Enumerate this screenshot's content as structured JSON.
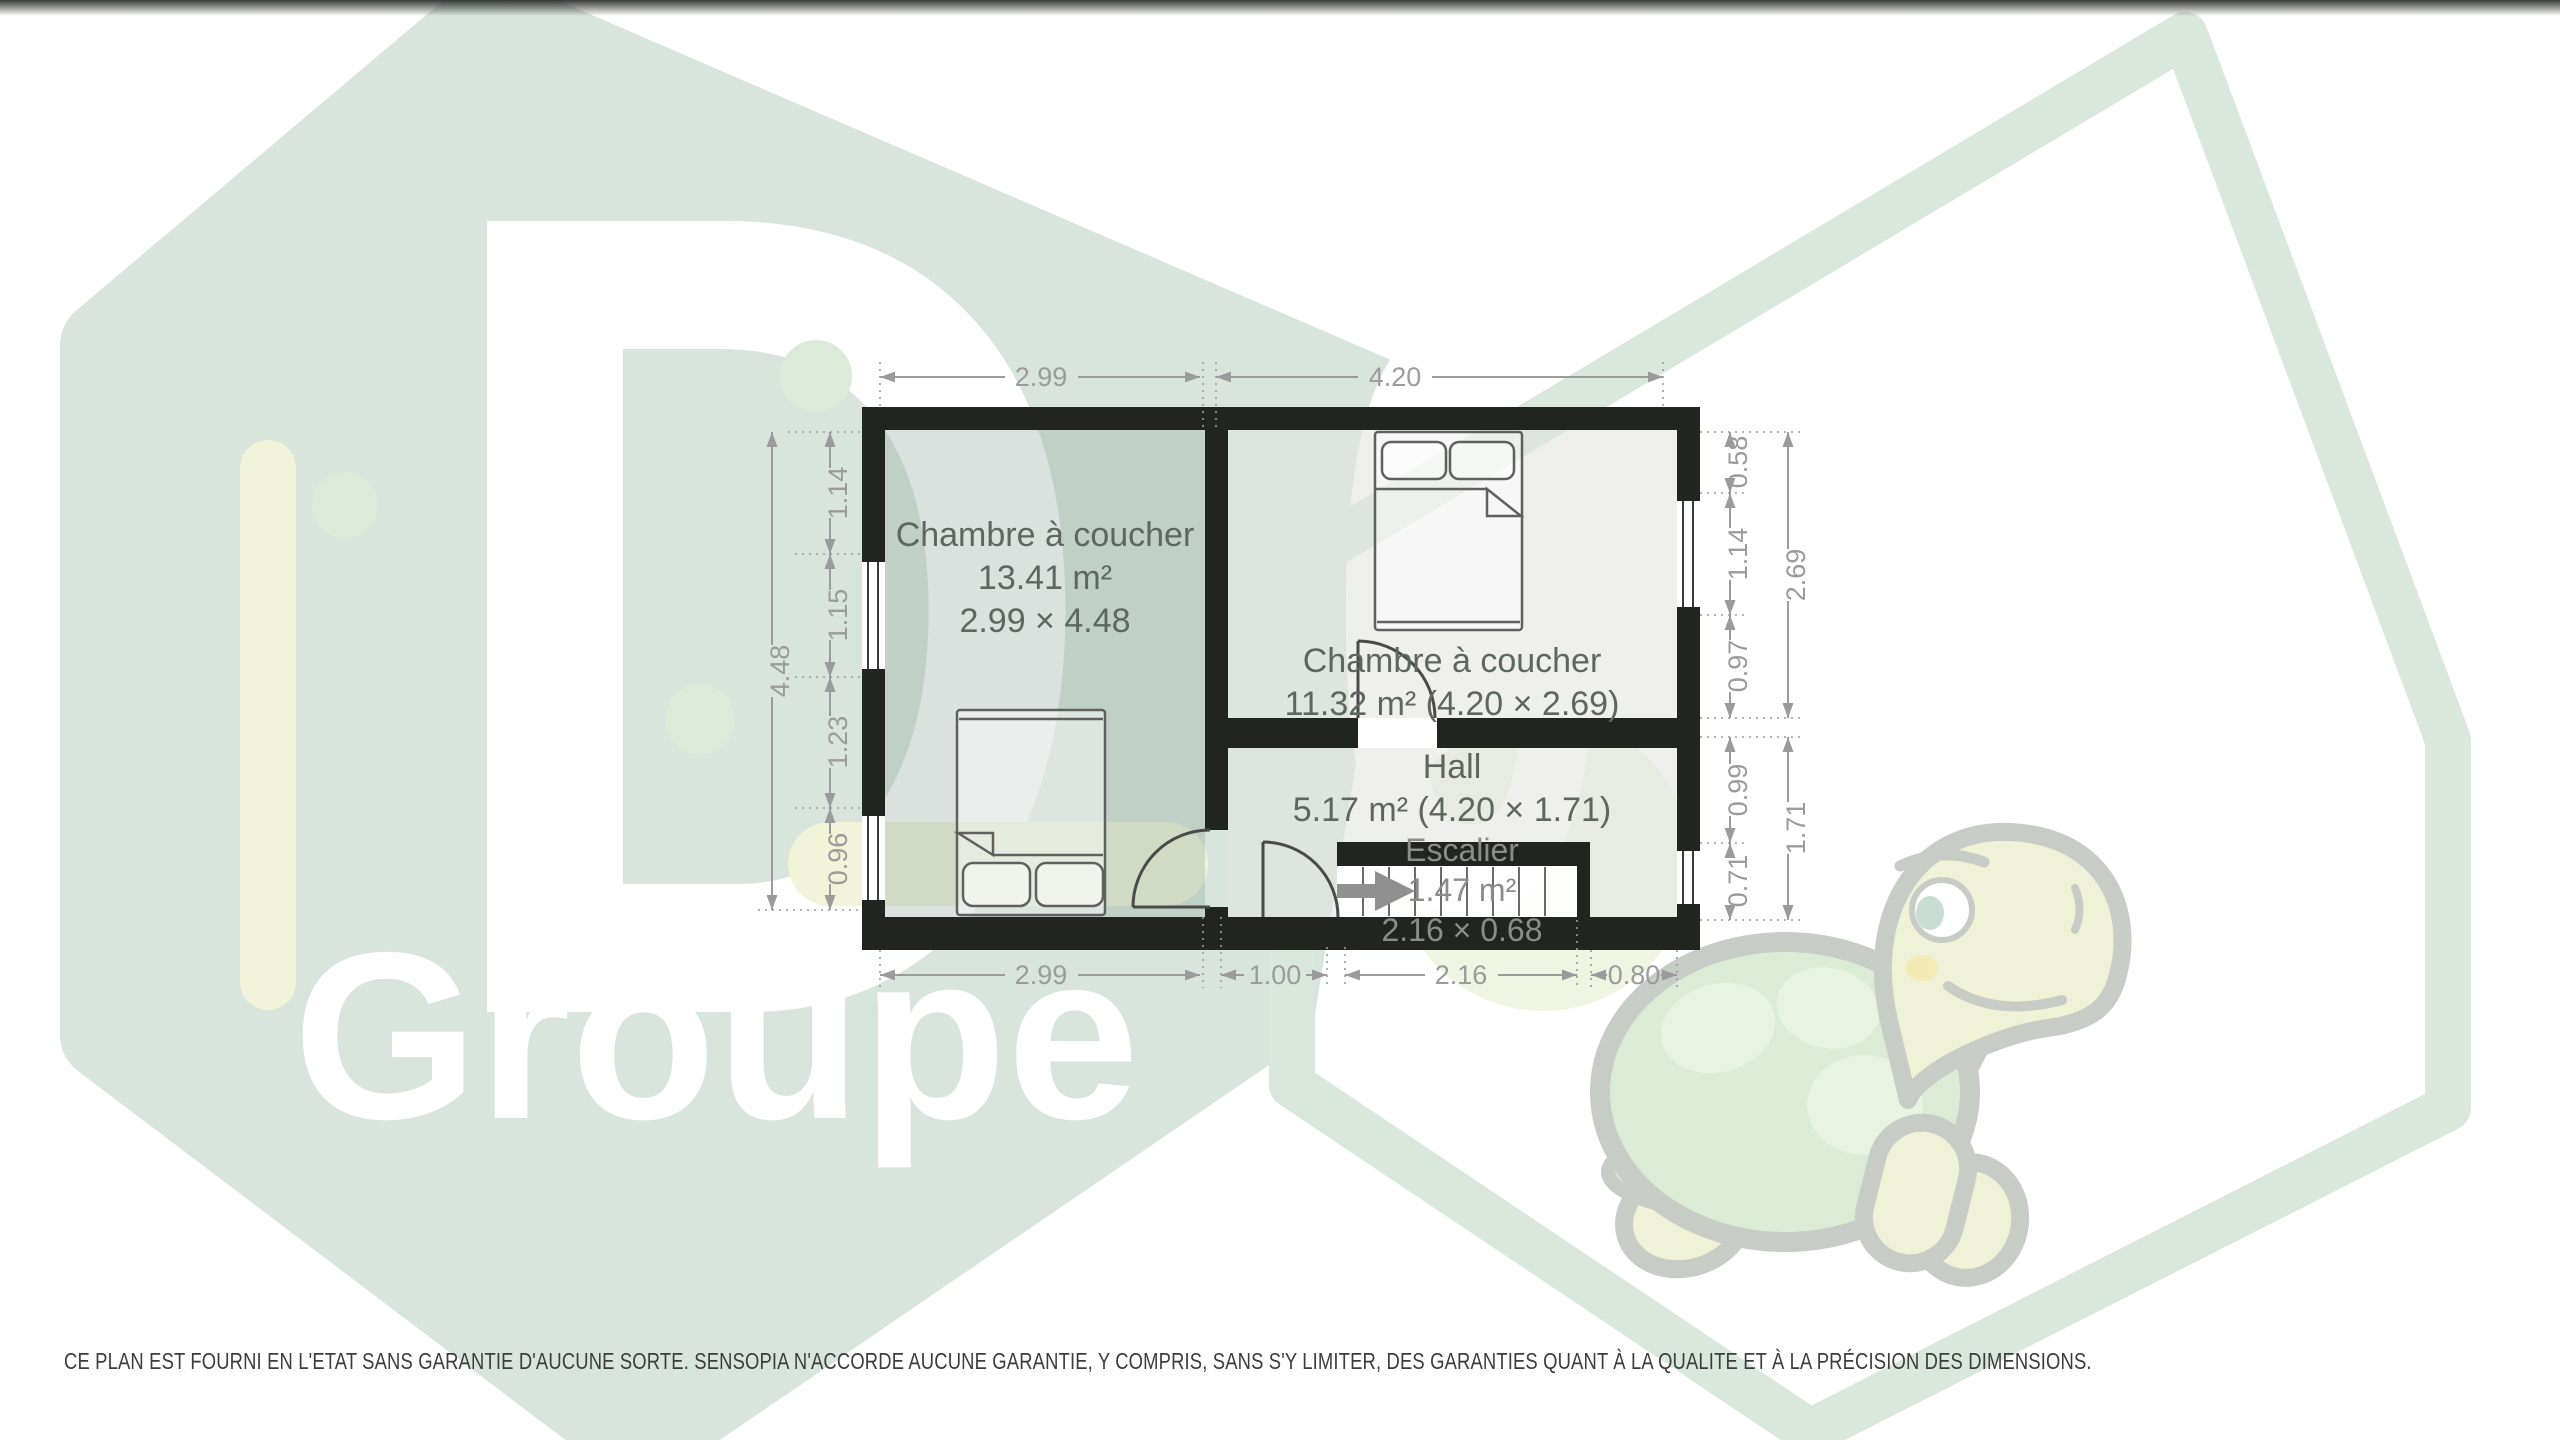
{
  "watermark": {
    "letter": "D",
    "word": "Groupe",
    "number": "056",
    "mascot": "turtle",
    "hex_green": "#d9e5dc",
    "hex_yellow": "#f2f4da",
    "outline_green": "#d9e7dd"
  },
  "plan": {
    "rooms": [
      {
        "label": "Chambre à coucher",
        "area": "13.41 m²",
        "size": "2.99 × 4.48"
      },
      {
        "label": "Chambre à coucher",
        "area": "11.32 m² (4.20 × 2.69)"
      },
      {
        "label": "Hall",
        "area": "5.17 m² (4.20 × 1.71)"
      },
      {
        "label": "Escalier",
        "area": "1.47 m²",
        "size": "2.16 × 0.68"
      }
    ],
    "dims": {
      "top": [
        "2.99",
        "4.20"
      ],
      "bottom": [
        "2.99",
        "1.00",
        "2.16",
        "0.80"
      ],
      "left_inner": [
        "1.14",
        "1.15",
        "1.23",
        "0.96"
      ],
      "left_total": "4.48",
      "right_inner": [
        "0.58",
        "1.14",
        "0.97",
        "0.99",
        "0.71"
      ],
      "right_outer": [
        "2.69",
        "1.71"
      ]
    },
    "wall_color": "#22251f",
    "dim_color": "#9b9b9b"
  },
  "footer": {
    "disclaimer": "CE PLAN EST FOURNI EN L'ETAT SANS GARANTIE D'AUCUNE SORTE. SENSOPIA N'ACCORDE AUCUNE GARANTIE, Y COMPRIS, SANS S'Y LIMITER, DES GARANTIES QUANT À LA QUALITE ET À LA PRÉCISION DES DIMENSIONS."
  }
}
